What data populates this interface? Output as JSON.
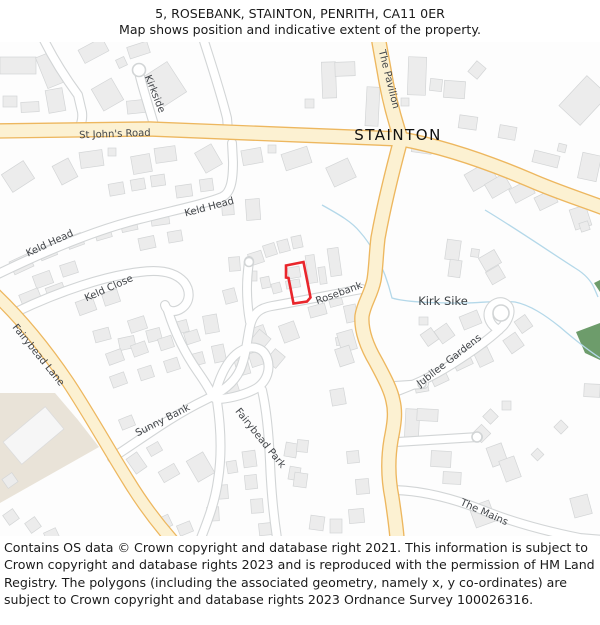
{
  "header": {
    "title": "5, ROSEBANK, STAINTON, PENRITH, CA11 0ER",
    "subtitle": "Map shows position and indicative extent of the property."
  },
  "map": {
    "settlement": "STAINTON",
    "water": "Kirk Sike",
    "streets": {
      "st_johns_road": "St John's Road",
      "kirkside": "Kirkside",
      "the_pavilion": "The Pavilion",
      "keld_head_west": "Keld Head",
      "keld_head_east": "Keld Head",
      "keld_close": "Keld Close",
      "rosebank": "Rosebank",
      "fairybead_lane": "Fairybead Lane",
      "sunny_bank": "Sunny Bank",
      "fairybead_park": "Fairybead Park",
      "jubilee_gardens": "Jubilee Gardens",
      "the_mains": "The Mains"
    },
    "property_marker": {
      "meaning": "red outline showing position and indicative extent of the property",
      "color": "#e9262c"
    },
    "colors": {
      "major_road_fill": "#fcf1d2",
      "major_road_border": "#edb75f",
      "minor_road_fill": "#ffffff",
      "minor_road_border": "#d2d5d6",
      "building_fill": "#ececec",
      "stream": "#b4d8e9",
      "green_area": "#6d9c6b",
      "tan_area": "#e9e3d8"
    }
  },
  "footer": {
    "text": "Contains OS data © Crown copyright and database right 2021. This information is subject to Crown copyright and database rights 2023 and is reproduced with the permission of HM Land Registry. The polygons (including the associated geometry, namely x, y co-ordinates) are subject to Crown copyright and database rights 2023 Ordnance Survey 100026316."
  }
}
